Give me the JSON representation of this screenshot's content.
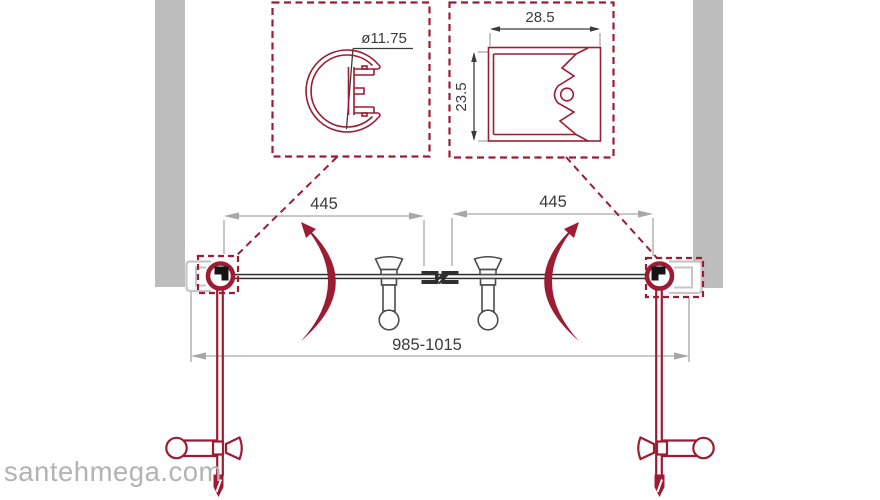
{
  "colors": {
    "accent_crimson": "#9d1c33",
    "wall_gray": "#bdbdbd",
    "profile_gray": "#c6c6c6",
    "dimension_gray": "#a7a7a7",
    "line_dark": "#3b3b3b",
    "knob_gray": "#4c4c4c",
    "glass_dark": "#2e2e2e",
    "watermark_gray": "#b3b3b3"
  },
  "detail_callouts": {
    "knob_profile": {
      "diameter_label": "ø11.75"
    },
    "wall_profile": {
      "width_label": "28.5",
      "height_label": "23.5"
    }
  },
  "dimensions": {
    "left_door_width": "445",
    "right_door_width": "445",
    "overall_width_range": "985-1015"
  },
  "watermark": {
    "text": "santehmega.com"
  }
}
